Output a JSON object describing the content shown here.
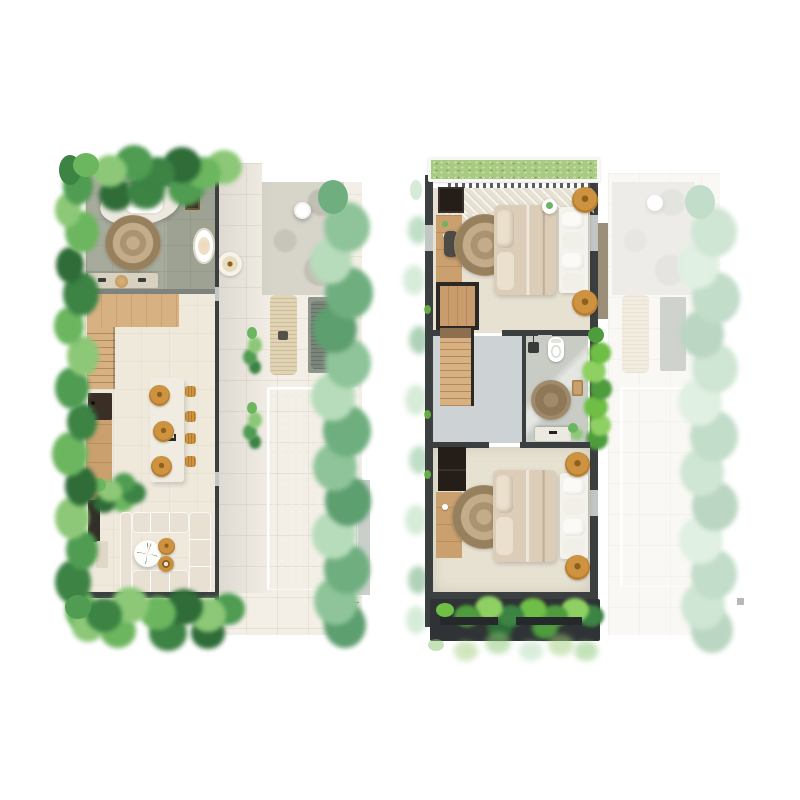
{
  "document": {
    "type": "villa floor plan sheet, top-down 3D render, two levels side by side",
    "views": [
      {
        "id": "ground-floor",
        "label": "Ground floor: open living, kitchen, spa bathroom, terrace and pool"
      },
      {
        "id": "upper-floor",
        "label": "Upper floor: two bedrooms and bathroom; ground-floor pool area shown faded"
      }
    ]
  },
  "plans": {
    "ground": {
      "rooms": [
        "spa bathroom",
        "stair landing",
        "kitchen",
        "dining",
        "living room",
        "terrace",
        "pool deck",
        "swimming pool",
        "garden borders"
      ],
      "furniture": [
        "freestanding bathtub on platform",
        "round jute rug",
        "double vanity with stool",
        "side bathtub",
        "staircase",
        "kitchen counter with range",
        "kitchen island",
        "three rattan stools",
        "four woven dining cushions",
        "U-shaped sectional sofa",
        "round coffee table",
        "two rattan poufs",
        "side table",
        "two sun loungers",
        "outdoor round table",
        "rattan pendant",
        "deck plants",
        "floor drain"
      ]
    },
    "upper": {
      "rooms": [
        "bedroom 1",
        "staircase",
        "hallway",
        "bathroom",
        "bedroom 2",
        "green roof strip",
        "balcony planter"
      ],
      "furniture": [
        "double bed with foot bench and cushions",
        "round jute rug",
        "desk with chair",
        "dark wardrobe",
        "rattan side tables",
        "round plant table",
        "stair void",
        "toilet",
        "shower head",
        "bath rug",
        "washbasin vanity",
        "wood shelf",
        "planter strip"
      ],
      "note": "ground-floor outdoor area repeated at reduced opacity on the right"
    }
  },
  "colors": {
    "paper": "#FFFFFF",
    "tile": "#F3EFE6",
    "pavement": "#D7D4CA",
    "poolTop": "#7FD6D2",
    "poolBottom": "#A9E4DD",
    "floorCream": "#EFE9DC",
    "bathFloor": "#A7AB9C",
    "bathFloor2": "#C8CCC5",
    "hallFloor": "#CDD2D4",
    "bedFloor": "#E7E1D2",
    "wallDark": "#3B3F40",
    "wallLight": "#C2C7C6",
    "wallSoft": "#7E837C",
    "wood": "#C9A06E",
    "woodLight": "#D8B183",
    "woodDark": "#3B2F25",
    "cabinetDark": "#322E28",
    "island": "#F0ECE1",
    "vanity": "#D8D1C0",
    "rattan": "#CE9340",
    "rattanDeep": "#8F601C",
    "rugLight": "#C3AC8A",
    "rugMid": "#AB9270",
    "rugDark": "#97805D",
    "duvet": "#DBCDB7",
    "pillow": "#EBE0CD",
    "bench": "#F4F2EC",
    "sofa": "#E8E1D3",
    "loungerBeige": "#E0D4B4",
    "loungerGray": "#8E968A",
    "grass": "#A9CA83",
    "grassDot": "#CBE0A8",
    "planterBox": "#2F3335",
    "ledge": "#8A7B63",
    "green1": "#4F9C52",
    "green2": "#6CB65F",
    "green3": "#3C8344",
    "green4": "#8CC877",
    "green5": "#2F6C38",
    "green6": "#A5CE7F",
    "sage1": "#8FC49A",
    "sage2": "#6FAF7F",
    "sage3": "#B7DCBB",
    "sage4": "#5E9F70",
    "bright1": "#6FBE45",
    "bright2": "#4E9C3E",
    "bright3": "#8ED062"
  }
}
